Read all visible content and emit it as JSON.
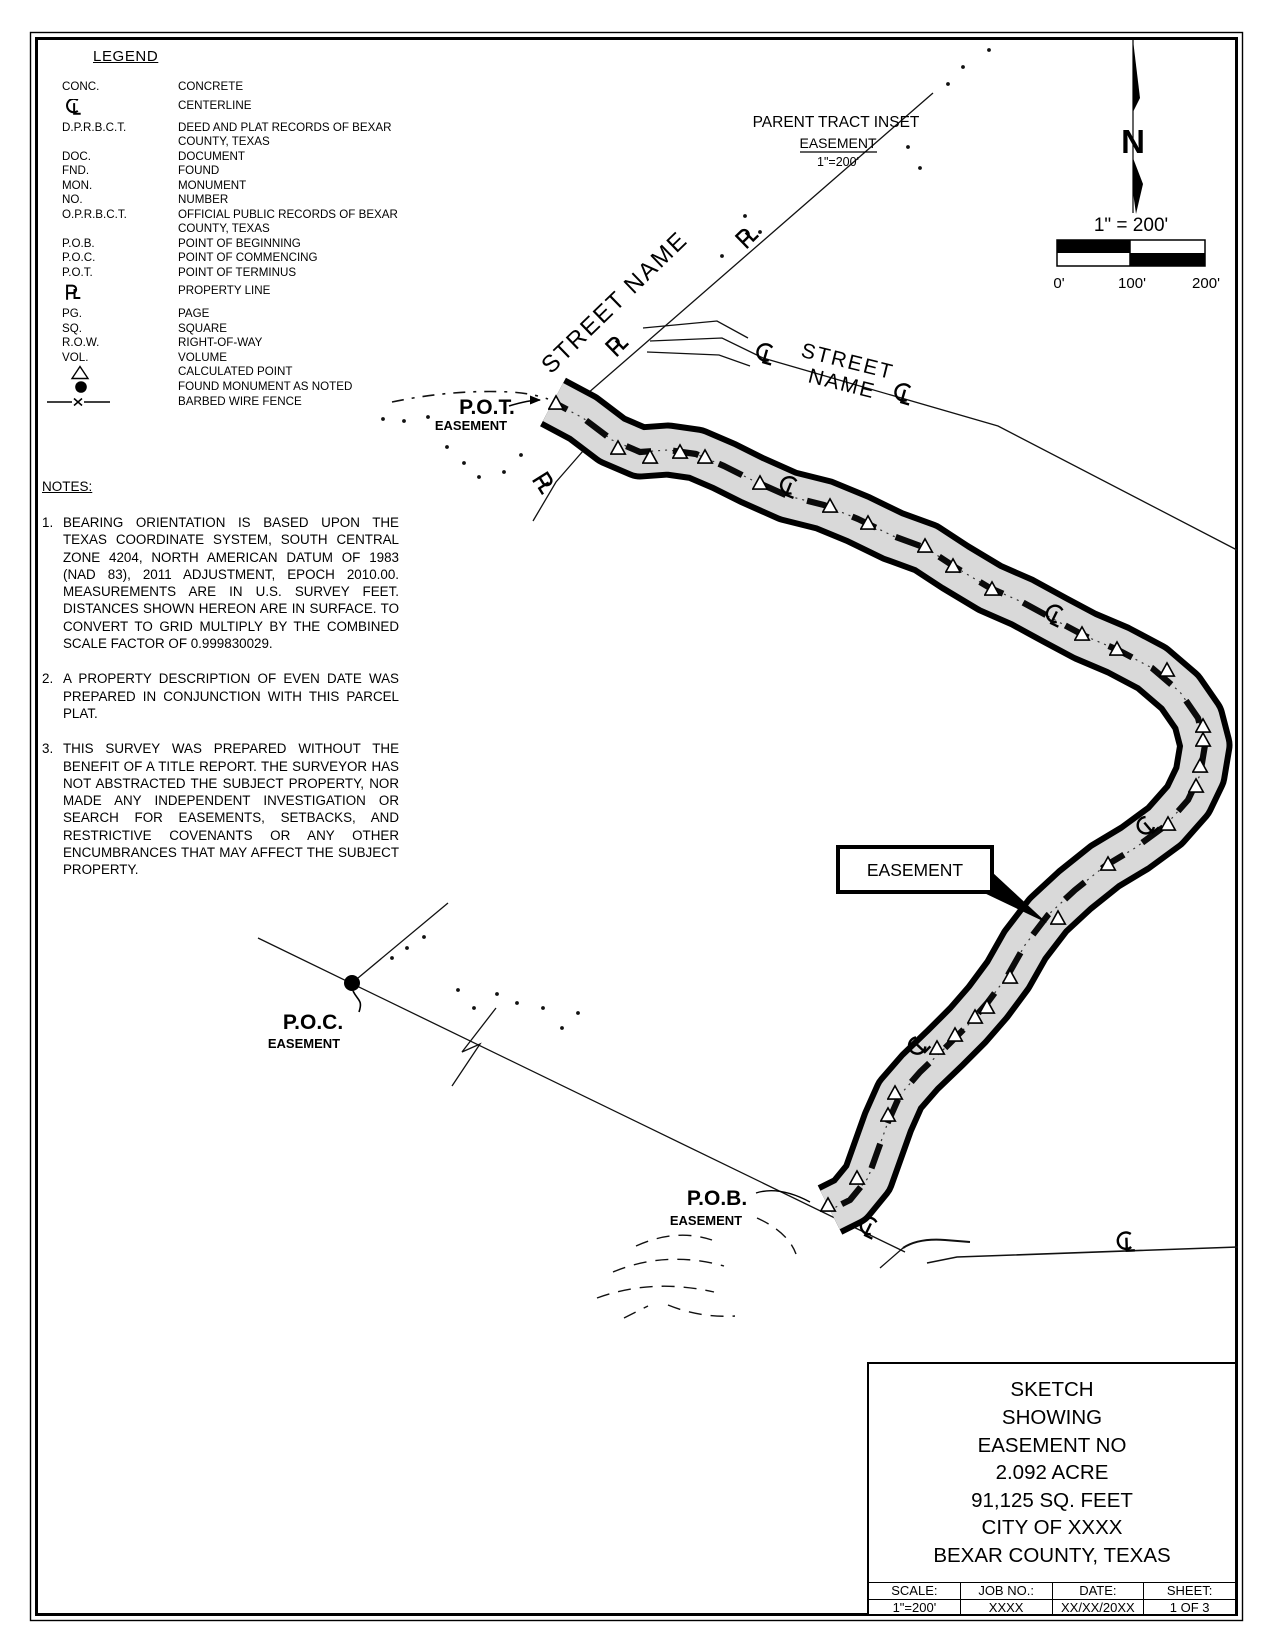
{
  "legend": {
    "title": "LEGEND",
    "rows": [
      {
        "abbr": "CONC.",
        "desc": "CONCRETE"
      },
      {
        "icon": "centerline-icon",
        "desc": "CENTERLINE"
      },
      {
        "abbr": "D.P.R.B.C.T.",
        "desc": "DEED AND PLAT RECORDS OF BEXAR COUNTY, TEXAS"
      },
      {
        "abbr": "DOC.",
        "desc": "DOCUMENT"
      },
      {
        "abbr": "FND.",
        "desc": "FOUND"
      },
      {
        "abbr": "MON.",
        "desc": "MONUMENT"
      },
      {
        "abbr": "NO.",
        "desc": "NUMBER"
      },
      {
        "abbr": "O.P.R.B.C.T.",
        "desc": "OFFICIAL PUBLIC RECORDS OF BEXAR COUNTY, TEXAS"
      },
      {
        "abbr": "P.O.B.",
        "desc": "POINT OF BEGINNING"
      },
      {
        "abbr": "P.O.C.",
        "desc": "POINT OF COMMENCING"
      },
      {
        "abbr": "P.O.T.",
        "desc": "POINT OF TERMINUS"
      },
      {
        "icon": "property-line-icon",
        "desc": "PROPERTY LINE"
      },
      {
        "abbr": "PG.",
        "desc": "PAGE"
      },
      {
        "abbr": "SQ.",
        "desc": "SQUARE"
      },
      {
        "abbr": "R.O.W.",
        "desc": "RIGHT-OF-WAY"
      },
      {
        "abbr": "VOL.",
        "desc": "VOLUME"
      },
      {
        "icon": "calculated-point-icon",
        "desc": "CALCULATED POINT"
      },
      {
        "icon": "found-monument-icon",
        "desc": "FOUND MONUMENT AS NOTED"
      },
      {
        "icon": "barbed-wire-fence-icon",
        "desc": "BARBED WIRE FENCE"
      }
    ]
  },
  "notes": {
    "title": "NOTES:",
    "items": [
      {
        "num": "1.",
        "text": "BEARING ORIENTATION IS BASED UPON THE TEXAS COORDINATE SYSTEM, SOUTH CENTRAL ZONE 4204, NORTH AMERICAN DATUM OF 1983 (NAD 83), 2011 ADJUSTMENT, EPOCH 2010.00. MEASUREMENTS ARE IN U.S. SURVEY FEET. DISTANCES SHOWN HEREON ARE IN SURFACE. TO CONVERT TO GRID MULTIPLY BY THE COMBINED SCALE FACTOR OF 0.999830029."
      },
      {
        "num": "2.",
        "text": "A PROPERTY DESCRIPTION OF EVEN DATE WAS PREPARED IN CONJUNCTION WITH THIS PARCEL PLAT."
      },
      {
        "num": "3.",
        "text": "THIS SURVEY WAS PREPARED WITHOUT THE BENEFIT OF A TITLE REPORT. THE SURVEYOR HAS NOT ABSTRACTED THE SUBJECT PROPERTY, NOR MADE ANY INDEPENDENT INVESTIGATION OR SEARCH FOR EASEMENTS, SETBACKS, AND RESTRICTIVE COVENANTS OR ANY OTHER ENCUMBRANCES THAT MAY AFFECT THE SUBJECT PROPERTY."
      }
    ]
  },
  "inset": {
    "title": "PARENT TRACT INSET",
    "subtitle": "EASEMENT",
    "scale": "1\"=200'"
  },
  "north": {
    "label": "N"
  },
  "scalebar": {
    "title": "1\" = 200'",
    "tick0": "0'",
    "tick1": "100'",
    "tick2": "200'"
  },
  "map": {
    "street1_label": "STREET NAME",
    "street2_label_line1": "STREET",
    "street2_label_line2": "NAME",
    "pot_title": "P.O.T.",
    "pot_sub": "EASEMENT",
    "poc_title": "P.O.C.",
    "poc_sub": "EASEMENT",
    "pob_title": "P.O.B.",
    "pob_sub": "EASEMENT",
    "callout_label": "EASEMENT"
  },
  "titleblock": {
    "lines": [
      "SKETCH",
      "SHOWING",
      "EASEMENT NO",
      "2.092 ACRE",
      "91,125 SQ. FEET",
      "CITY OF XXXX",
      "BEXAR COUNTY, TEXAS"
    ],
    "fields": [
      {
        "label": "SCALE:",
        "value": "1\"=200'"
      },
      {
        "label": "JOB NO.:",
        "value": "XXXX"
      },
      {
        "label": "DATE:",
        "value": "XX/XX/20XX"
      },
      {
        "label": "SHEET:",
        "value": "1 OF 3"
      }
    ]
  },
  "colors": {
    "ink": "#000000",
    "corridor_fill": "#d9d9d9"
  }
}
